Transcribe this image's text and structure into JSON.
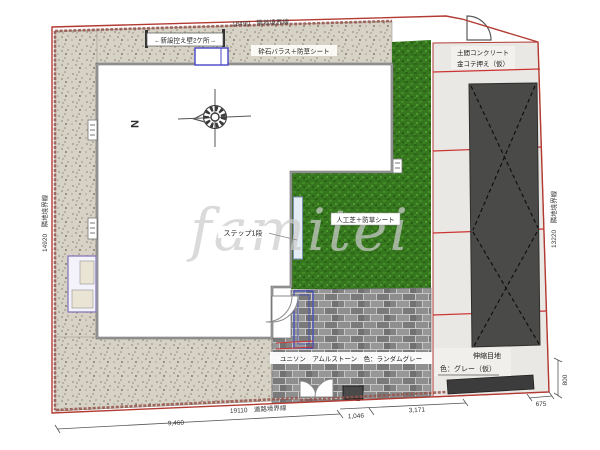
{
  "plan": {
    "boundaries": {
      "top": "18490　隣地境界線",
      "left": "14920　隣地境界線",
      "right": "13220　隣地境界線",
      "road": "19110　道路境界線"
    },
    "materials": {
      "retaining_wall": "←新設控え壁2ケ所→",
      "gravel": "砕石バラス＋防草シート",
      "concrete_1": "土間コンクリート",
      "concrete_2": "金コテ押え（仮）",
      "grass": "人工芝＋防草シート",
      "step": "ステップ1段",
      "paver": "ユニソン　アムルストーン　色：ランダムグレー",
      "joint_1": "伸縮目地",
      "joint_2": "色：グレー（仮）"
    },
    "dimensions": {
      "front_width": "9,460",
      "entrance": "1,046",
      "approach": "3,171",
      "side": "675",
      "depth": "800"
    },
    "compass": {
      "north": "N"
    },
    "watermark": {
      "text": "famitei"
    },
    "colors": {
      "boundary_red": "#b23a32",
      "joint_red": "#cc3333",
      "grass_green": "#36761f",
      "concrete_gray": "#eae8e4",
      "parking_dark": "#4a4a48",
      "accent_blue": "#3b49c0"
    }
  }
}
